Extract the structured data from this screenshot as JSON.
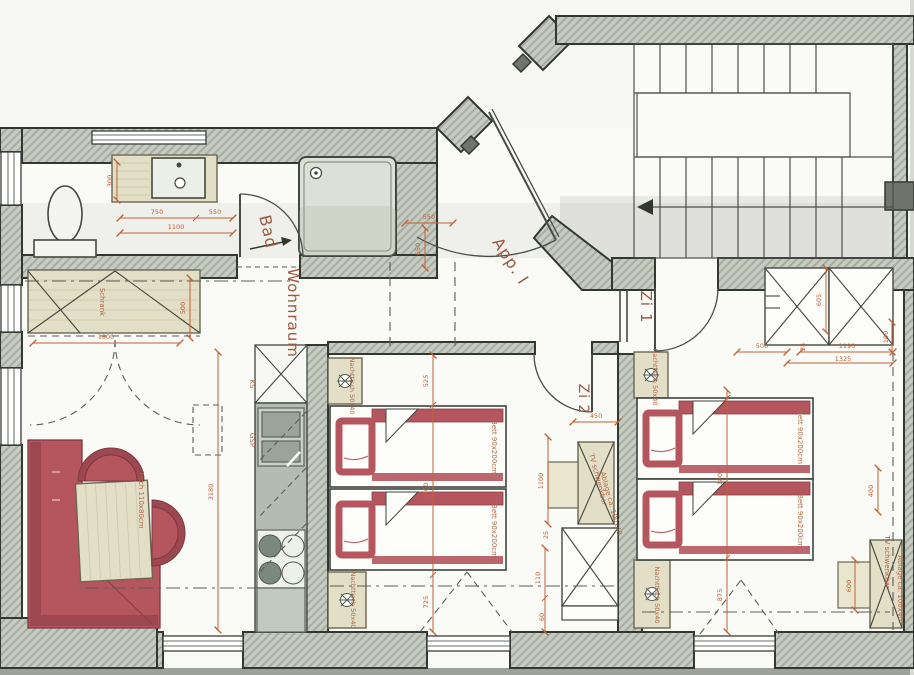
{
  "plan": {
    "room_labels": [
      {
        "text": "Bad",
        "x": 263,
        "y": 233,
        "rot": 77,
        "size": 16
      },
      {
        "text": "Wohnraum",
        "x": 288,
        "y": 313,
        "rot": 90,
        "size": 15
      },
      {
        "text": "App. I",
        "x": 506,
        "y": 264,
        "rot": 57,
        "size": 16
      },
      {
        "text": "Zi 1",
        "x": 641,
        "y": 307,
        "rot": 90,
        "size": 15
      },
      {
        "text": "Zi 2",
        "x": 579,
        "y": 399,
        "rot": 90,
        "size": 14
      }
    ],
    "furniture_labels": [
      {
        "text": "Schrank",
        "x": 100,
        "y": 302,
        "rot": 90,
        "size": 7
      },
      {
        "text": "Tisch 110x80cm",
        "x": 139,
        "y": 500,
        "rot": 90,
        "size": 7
      },
      {
        "text": "KS",
        "x": 250,
        "y": 384,
        "rot": 90,
        "size": 7
      },
      {
        "text": "GSP",
        "x": 250,
        "y": 440,
        "rot": 90,
        "size": 7
      },
      {
        "text": "Nachttisch 50x40",
        "x": 350,
        "y": 386,
        "rot": 90,
        "size": 6.5
      },
      {
        "text": "Nachttisch 50x40",
        "x": 351,
        "y": 600,
        "rot": 90,
        "size": 6.5
      },
      {
        "text": "Bett 90x200cm",
        "x": 492,
        "y": 447,
        "rot": 90,
        "size": 7
      },
      {
        "text": "Bett 90x200cm",
        "x": 492,
        "y": 531,
        "rot": 90,
        "size": 7
      },
      {
        "text": "TV schwenkbar",
        "x": 596,
        "y": 480,
        "rot": 75,
        "size": 7
      },
      {
        "text": "Ablage ca. 100x40",
        "x": 609,
        "y": 504,
        "rot": 75,
        "size": 7
      },
      {
        "text": "Nachttisch 50x40",
        "x": 653,
        "y": 377,
        "rot": 90,
        "size": 6.5
      },
      {
        "text": "Nachttisch 50x40",
        "x": 655,
        "y": 595,
        "rot": 90,
        "size": 6.5
      },
      {
        "text": "Bett 90x200cm",
        "x": 798,
        "y": 437,
        "rot": 90,
        "size": 7
      },
      {
        "text": "Bett 90x200cm",
        "x": 798,
        "y": 521,
        "rot": 90,
        "size": 7
      },
      {
        "text": "TV schwenkbar",
        "x": 885,
        "y": 562,
        "rot": 90,
        "size": 7
      },
      {
        "text": "Ablage ca. 100x40",
        "x": 898,
        "y": 588,
        "rot": 90,
        "size": 7
      }
    ],
    "dimension_labels": [
      {
        "text": "750",
        "x": 157,
        "y": 214
      },
      {
        "text": "550",
        "x": 215,
        "y": 214
      },
      {
        "text": "1100",
        "x": 176,
        "y": 229
      },
      {
        "text": "300",
        "x": 112,
        "y": 181,
        "rot": -90
      },
      {
        "text": "550",
        "x": 429,
        "y": 219
      },
      {
        "text": "650",
        "x": 420,
        "y": 249,
        "rot": -90
      },
      {
        "text": "1800",
        "x": 106,
        "y": 339
      },
      {
        "text": "500",
        "x": 185,
        "y": 308,
        "rot": -90
      },
      {
        "text": "3180",
        "x": 213,
        "y": 492,
        "rot": -90
      },
      {
        "text": "525",
        "x": 428,
        "y": 381,
        "rot": -90
      },
      {
        "text": "1800",
        "x": 428,
        "y": 491,
        "rot": -90
      },
      {
        "text": "725",
        "x": 428,
        "y": 602,
        "rot": -90
      },
      {
        "text": "450",
        "x": 596,
        "y": 418
      },
      {
        "text": "1100",
        "x": 543,
        "y": 481,
        "rot": -90
      },
      {
        "text": "25",
        "x": 548,
        "y": 535,
        "rot": -90
      },
      {
        "text": "110",
        "x": 540,
        "y": 578,
        "rot": -90
      },
      {
        "text": "60",
        "x": 544,
        "y": 617,
        "rot": -90
      },
      {
        "text": "500",
        "x": 762,
        "y": 348
      },
      {
        "text": "1190",
        "x": 847,
        "y": 348
      },
      {
        "text": "1325",
        "x": 843,
        "y": 361
      },
      {
        "text": "25",
        "x": 805,
        "y": 347,
        "rot": -90
      },
      {
        "text": "100",
        "x": 888,
        "y": 337,
        "rot": -90
      },
      {
        "text": "605",
        "x": 821,
        "y": 300,
        "rot": -90
      },
      {
        "text": "1800",
        "x": 722,
        "y": 477,
        "rot": -90
      },
      {
        "text": "875",
        "x": 722,
        "y": 595,
        "rot": -90
      },
      {
        "text": "400",
        "x": 873,
        "y": 491,
        "rot": -90
      },
      {
        "text": "600",
        "x": 851,
        "y": 586,
        "rot": -90
      }
    ],
    "colors": {
      "dimension_text": "#bf6238",
      "room_label_text": "#9c5a40",
      "wall_fill": "#c7ccc3",
      "upholstery_red": "#b5565e",
      "furniture_wood": "#e3dec6"
    }
  }
}
